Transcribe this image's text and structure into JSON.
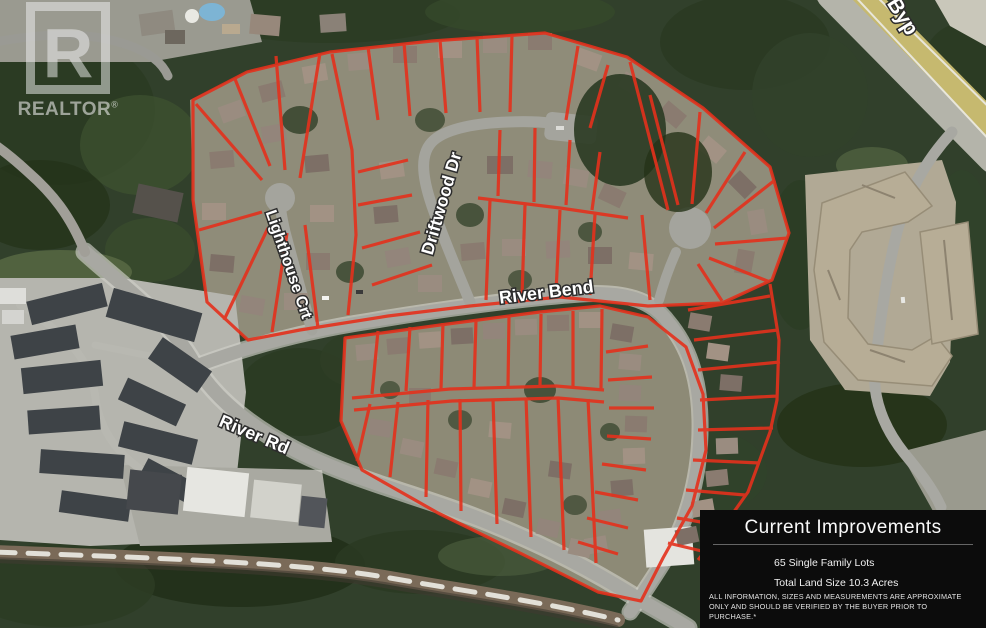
{
  "watermark": {
    "letter": "R",
    "brand": "REALTOR",
    "registered": "®"
  },
  "map": {
    "street_labels": [
      {
        "id": "driftwood",
        "text": "Driftwood Dr"
      },
      {
        "id": "lighthouse",
        "text": "Lighthouse Crt"
      },
      {
        "id": "river_bend",
        "text": "River Bend"
      },
      {
        "id": "river_rd",
        "text": "River Rd"
      },
      {
        "id": "bypass",
        "text": "Byp"
      }
    ],
    "colors": {
      "lot_line": "#e4311c",
      "road": "#a8a8a2",
      "forest": "#31402b",
      "highway": "#c6b96f"
    }
  },
  "info_panel": {
    "title": "Current Improvements",
    "stats": [
      "65 Single Family Lots",
      "Total Land Size 10.3 Acres"
    ],
    "disclaimer": "ALL INFORMATION, SIZES AND MEASUREMENTS ARE APPROXIMATE ONLY AND SHOULD BE VERIFIED BY THE BUYER PRIOR TO PURCHASE.*"
  }
}
